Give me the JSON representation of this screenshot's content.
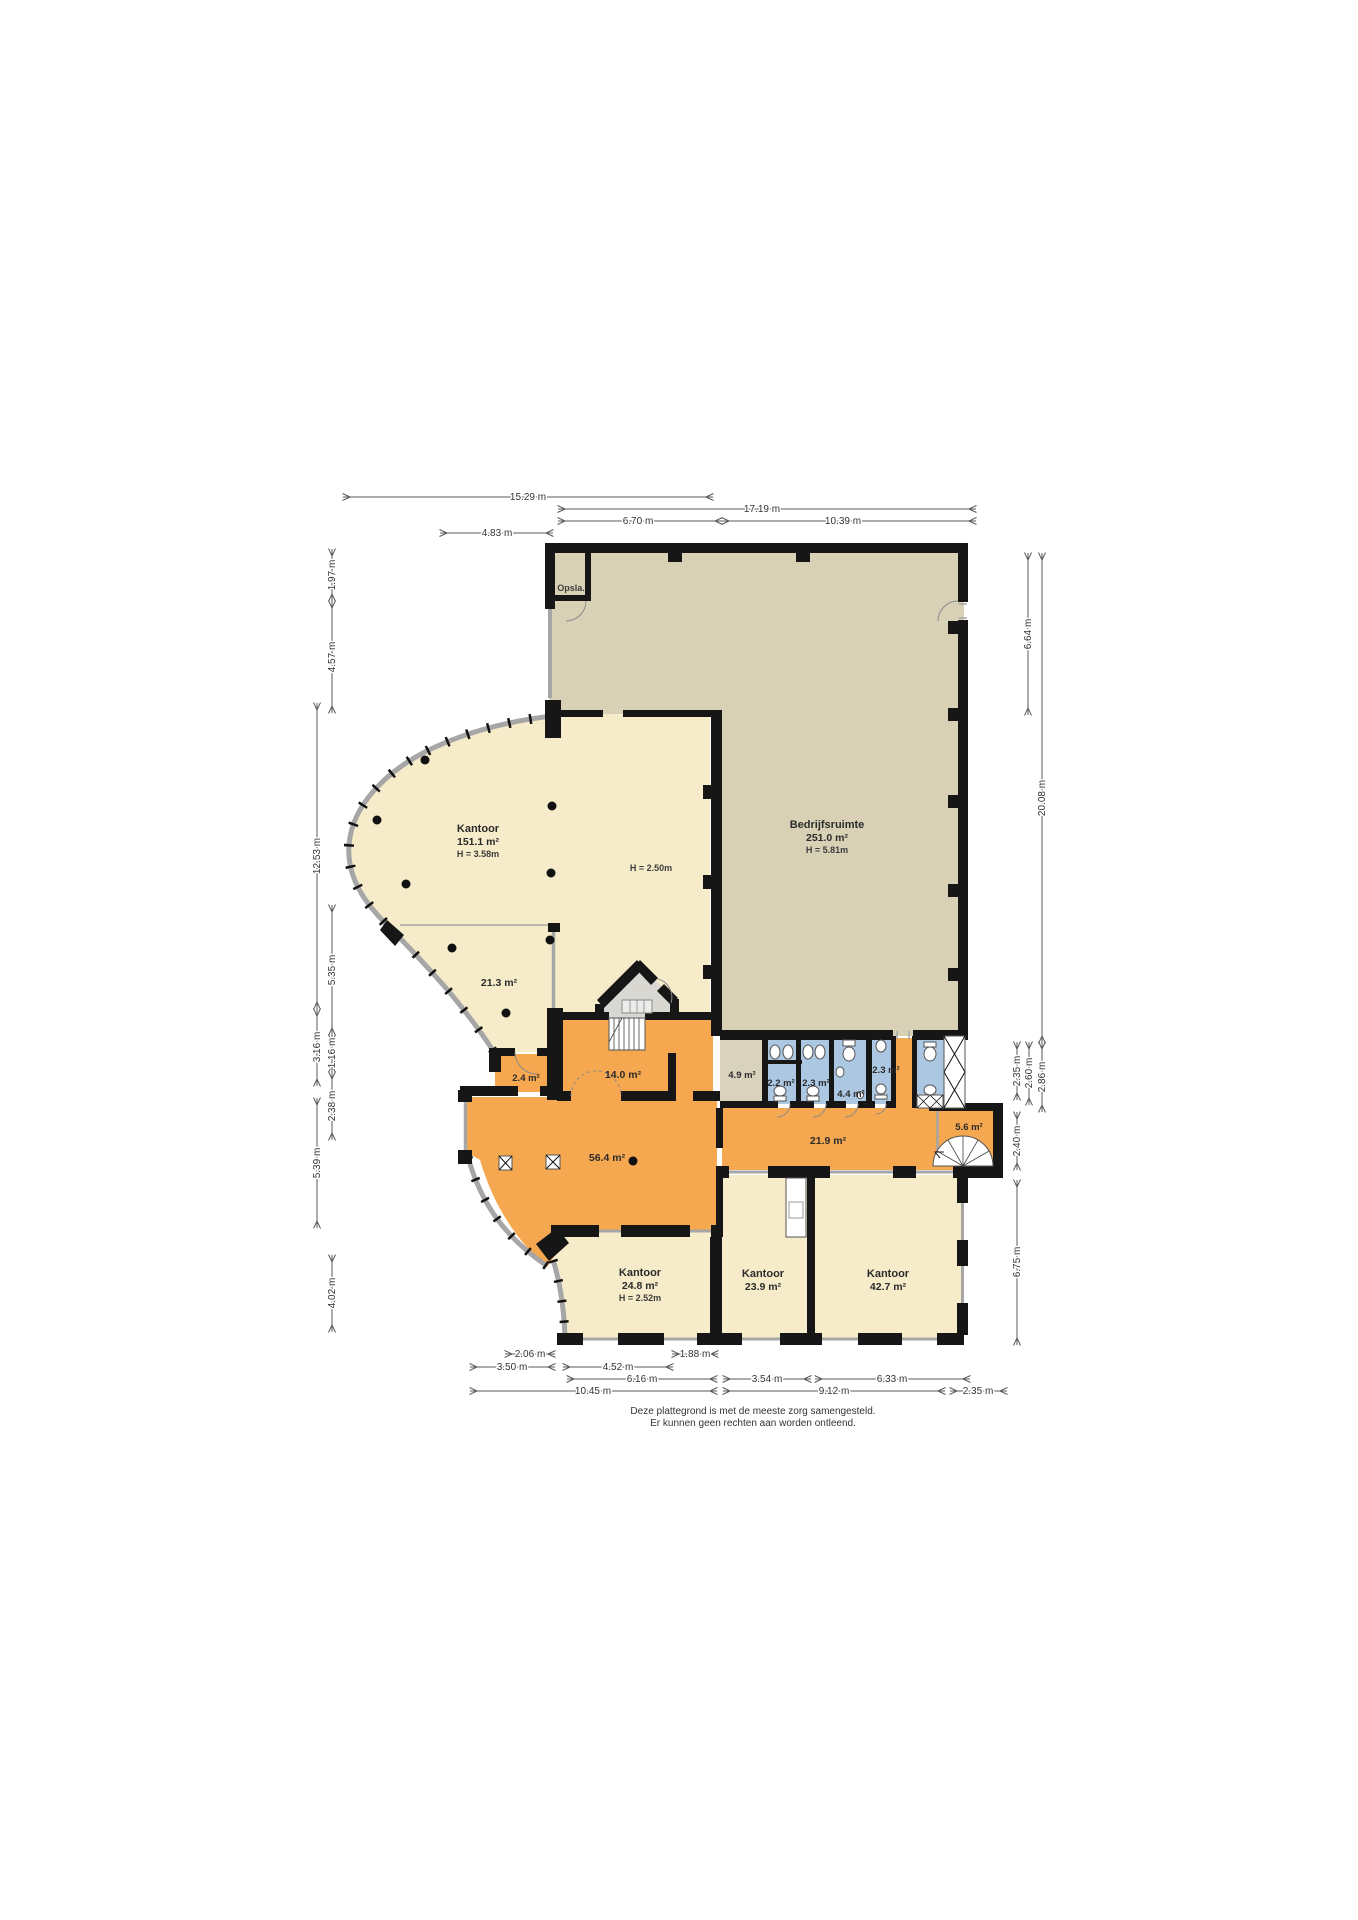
{
  "rooms": {
    "opslag": {
      "name": "Opsla."
    },
    "kantoor_main": {
      "name": "Kantoor",
      "area": "151.1 m²",
      "height": "H = 3.58m",
      "height_note": "H = 2.50m"
    },
    "bedrijfsruimte": {
      "name": "Bedrijfsruimte",
      "area": "251.0 m²",
      "height": "H = 5.81m"
    },
    "a21_3": {
      "area": "21.3 m²"
    },
    "a2_4": {
      "area": "2.4 m²"
    },
    "a14_0": {
      "area": "14.0 m²"
    },
    "a4_9": {
      "area": "4.9 m²"
    },
    "wc2_2": {
      "area": "2.2 m²"
    },
    "wc2_3a": {
      "area": "2.3 m²"
    },
    "wc4_4": {
      "area": "4.4 m²"
    },
    "wc2_3b": {
      "area": "2.3 m²"
    },
    "a5_6": {
      "area": "5.6 m²"
    },
    "hal56_4": {
      "area": "56.4 m²"
    },
    "gang21_9": {
      "area": "21.9 m²"
    },
    "kantoor_24_8": {
      "name": "Kantoor",
      "area": "24.8 m²",
      "height": "H = 2.52m"
    },
    "kantoor_23_9": {
      "name": "Kantoor",
      "area": "23.9 m²"
    },
    "kantoor_42_7": {
      "name": "Kantoor",
      "area": "42.7 m²"
    }
  },
  "dims": {
    "top": [
      "15.29 m",
      "17.19 m",
      "6.70 m",
      "10.39 m",
      "4.83 m"
    ],
    "left": [
      "1.97 m",
      "4.57 m",
      "12.53 m",
      "5.35 m",
      "3.16 m",
      "1.16 m",
      "2.38 m",
      "5.39 m",
      "4.02 m"
    ],
    "right": [
      "6.64 m",
      "20.08 m",
      "2.35 m",
      "2.60 m",
      "2.86 m",
      "2.40 m",
      "6.75 m"
    ],
    "bottom": [
      "2.06 m",
      "1.88 m",
      "3.50 m",
      "4.52 m",
      "6.16 m",
      "3.54 m",
      "6.33 m",
      "10.45 m",
      "9.12 m",
      "2.35 m"
    ]
  },
  "footer": {
    "line1": "Deze plattegrond is met de meeste zorg samengesteld.",
    "line2": "Er kunnen geen rechten aan worden ontleend."
  },
  "colors": {
    "cream": "#f6ecca",
    "tan": "#d9d1b6",
    "orange": "#f5a84f",
    "blue": "#abc7e2",
    "gray_room": "#d8d7d2",
    "wall": "#161616"
  }
}
